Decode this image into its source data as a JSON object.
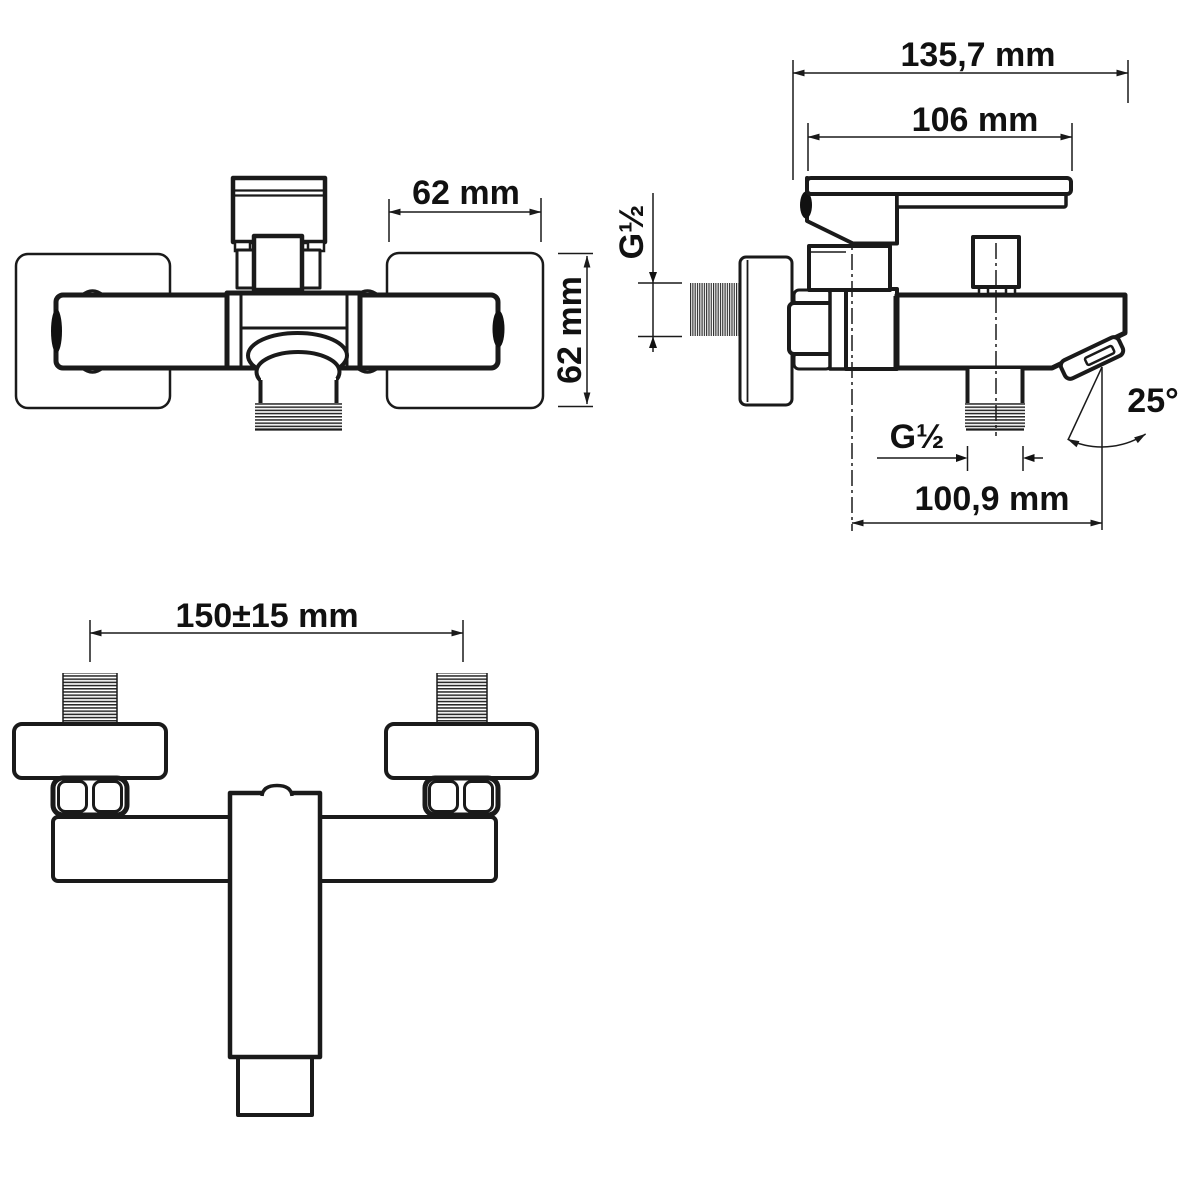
{
  "drawing": {
    "kind": "faucet technical drawing, three orthographic views",
    "background_color": "#ffffff",
    "line_color": "#1a1a1a",
    "views": {
      "top": {
        "name": "top-view",
        "dim_plate_width": "62 mm",
        "dim_plate_height": "62 mm"
      },
      "side": {
        "name": "side-view",
        "dim_overall_depth": "135,7 mm",
        "dim_handle_length": "106 mm",
        "dim_inlet_thread": "G½",
        "dim_outlet_thread": "G½",
        "dim_spout_reach": "100,9 mm",
        "dim_spout_angle": "25°"
      },
      "front": {
        "name": "front-view",
        "dim_inlet_spacing": "150±15 mm"
      }
    }
  }
}
